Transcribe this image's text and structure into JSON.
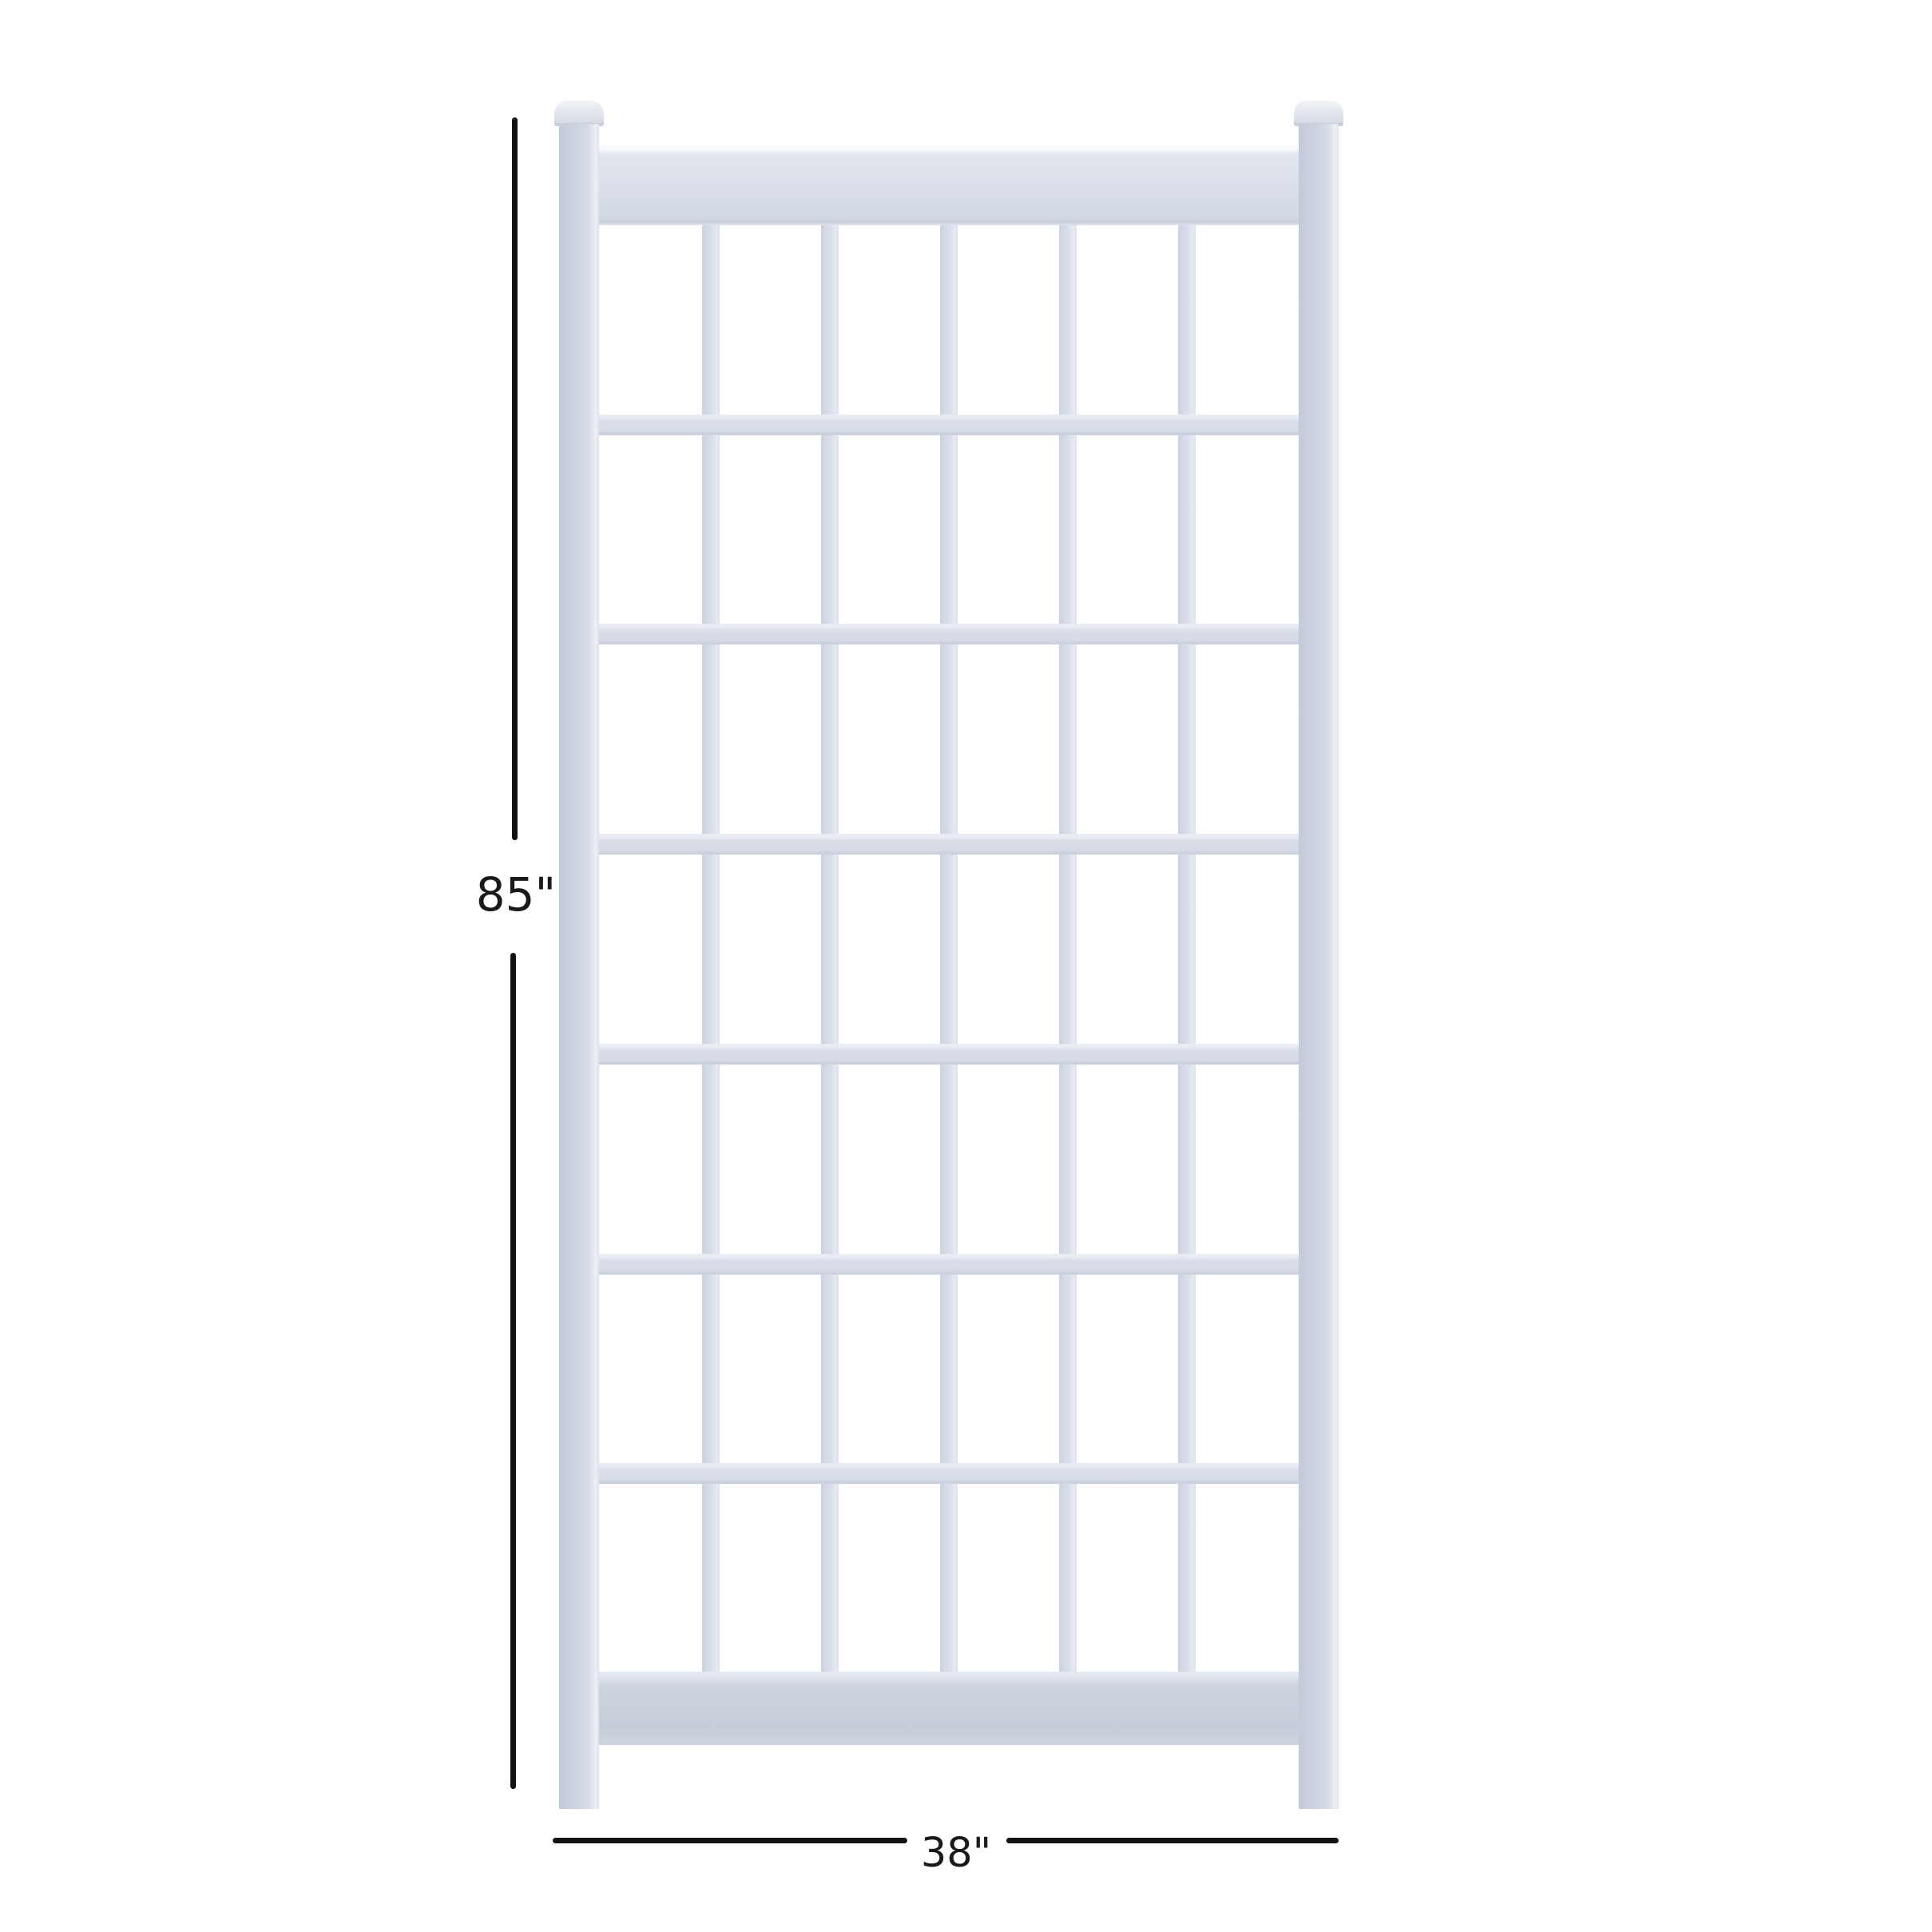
{
  "figure": {
    "type": "product-dimension-diagram",
    "subject": "white grid trellis panel with capped posts",
    "height_label": "85\"",
    "width_label": "38\"",
    "grid": {
      "opening_columns": 6,
      "opening_rows": 7,
      "vertical_slats": 5,
      "horizontal_slats": 6,
      "posts": 2
    }
  },
  "colors": {
    "background": "#ffffff",
    "dimension_line": "#121212",
    "label_text": "#1a1a1a",
    "trellis_post": "#ccd3e0",
    "trellis_top_rail": "#d9dee8",
    "trellis_bottom_rail": "#c6ccd9",
    "trellis_slat": "#d8dde8",
    "highlight": "#f6f8fa"
  }
}
